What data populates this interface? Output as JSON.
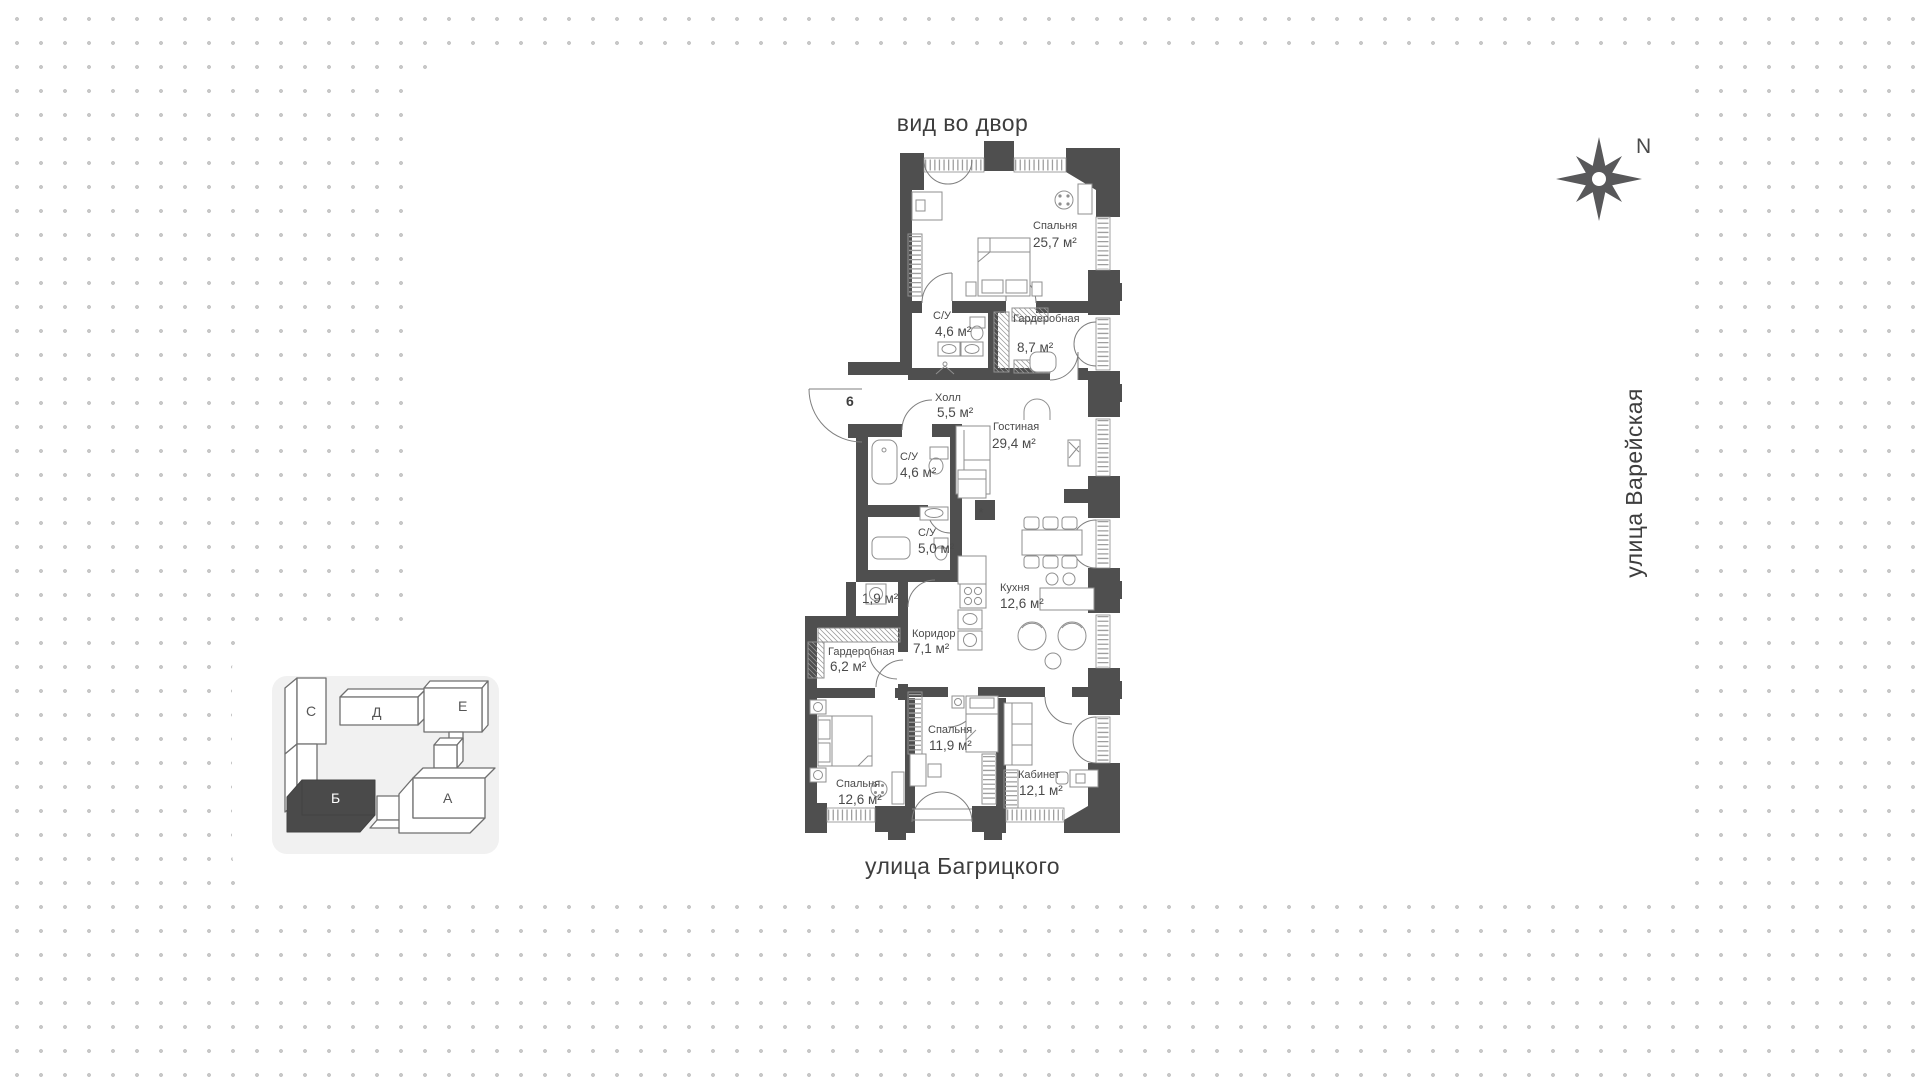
{
  "header": {
    "top_view_label": "вид во двор"
  },
  "streets": {
    "bottom": "улица Багрицкого",
    "right": "улица Варейская"
  },
  "compass": {
    "label": "N"
  },
  "plan": {
    "entrance_number": "6",
    "rooms": [
      {
        "name": "Спальня",
        "area": "25,7 м²"
      },
      {
        "name": "С/У",
        "area": "4,6 м²"
      },
      {
        "name": "Гардеробная",
        "area": "8,7 м²"
      },
      {
        "name": "Холл",
        "area": "5,5 м²"
      },
      {
        "name": "Гостиная",
        "area": "29,4 м²"
      },
      {
        "name": "С/У",
        "area": "4,6 м²"
      },
      {
        "name": "С/У",
        "area": "5,0 м²"
      },
      {
        "name": "",
        "area": "1,9 м²"
      },
      {
        "name": "Кухня",
        "area": "12,6 м²"
      },
      {
        "name": "Коридор",
        "area": "7,1 м²"
      },
      {
        "name": "Гардеробная",
        "area": "6,2 м²"
      },
      {
        "name": "Спальня",
        "area": "11,9 м²"
      },
      {
        "name": "Спальня",
        "area": "12,6 м²"
      },
      {
        "name": "Кабинет",
        "area": "12,1 м²"
      }
    ]
  },
  "building_key": {
    "selected": "Б",
    "sections": [
      {
        "label": "С"
      },
      {
        "label": "Д"
      },
      {
        "label": "Е"
      },
      {
        "label": "Б"
      },
      {
        "label": "А"
      }
    ]
  },
  "colors": {
    "wall": "#4f4f4f",
    "dots": "#c8c8c8",
    "text": "#4a4a4a",
    "key_card_bg": "#f1f1f1",
    "key_selected_fill": "#4a4a4a"
  }
}
